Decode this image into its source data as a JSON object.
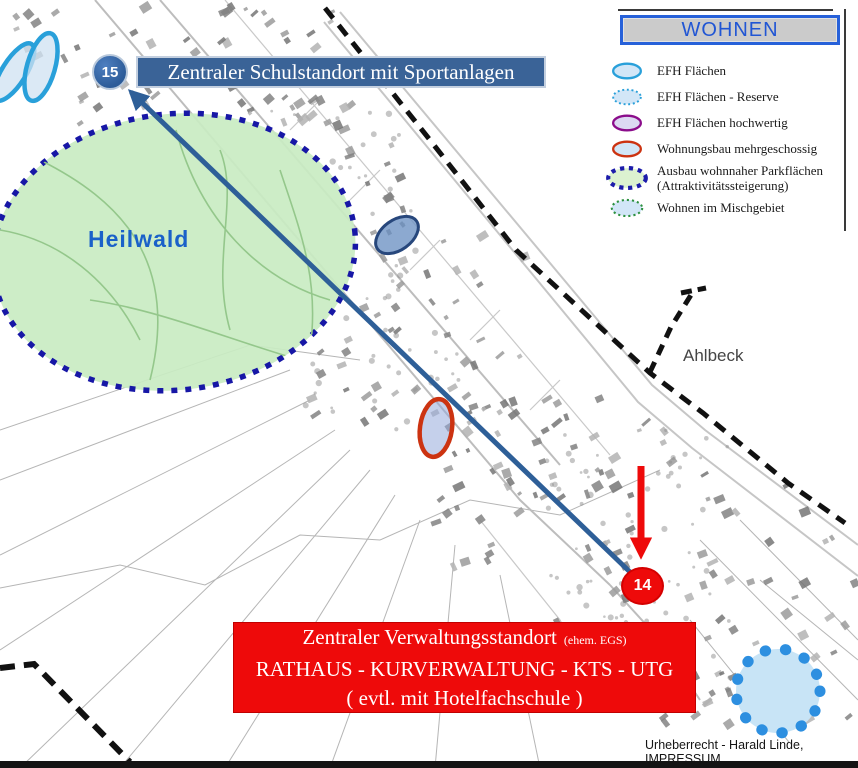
{
  "banners": {
    "school": {
      "marker": "15",
      "text": "Zentraler Schulstandort mit Sportanlagen"
    },
    "verwaltung": {
      "marker": "14",
      "line1": "Zentraler Verwaltungsstandort",
      "line1_note": "(ehem. EGS)",
      "line2": "RATHAUS - KURVERWALTUNG - KTS - UTG",
      "line3": "( evtl. mit Hotelfachschule )"
    }
  },
  "legend": {
    "title": "WOHNEN",
    "items": [
      {
        "label": "EFH Flächen",
        "swatch": "efh"
      },
      {
        "label": "EFH Flächen - Reserve",
        "swatch": "efh-reserve"
      },
      {
        "label": "EFH Flächen hochwertig",
        "swatch": "efh-hochwertig"
      },
      {
        "label": "Wohnungsbau mehrgeschossig",
        "swatch": "wohnungsbau"
      },
      {
        "label": "Ausbau wohnnaher Parkflächen\n(Attraktivitätssteigerung)",
        "swatch": "parkflaechen"
      },
      {
        "label": "Wohnen im Mischgebiet",
        "swatch": "mischgebiet"
      }
    ]
  },
  "map_labels": {
    "forest": "Heilwald",
    "town": "Ahlbeck"
  },
  "footer": {
    "copyright": "Urheberrecht - Harald Linde, IMPRESSUM"
  },
  "colors": {
    "banner-blue": "#3a6397",
    "marker-blue": "#2d5c99",
    "arrow-blue": "#2e5f98",
    "red": "#ee0a0a",
    "wohnungsbau-red": "#cc3311",
    "legend-blue": "#2761d9",
    "legend-title-text": "#2156d4",
    "efh-blue": "#29a0da",
    "efh-fill": "#d2e6f7",
    "hochwertig-purple": "#8b0d8b",
    "hochwertig-fill": "#dcd9f2",
    "park-navy": "#1c1caa",
    "park-fill": "#dcf2d0",
    "misch-green": "#2d9140",
    "misch-fill": "#cfe2f5",
    "forest-fill": "#c9ecc2",
    "forest-border": "#1717a6",
    "forest-label": "#1a61c9",
    "reserve-dot-blue": "#2d8fe0",
    "reserve-fill": "#c8e4f6"
  }
}
